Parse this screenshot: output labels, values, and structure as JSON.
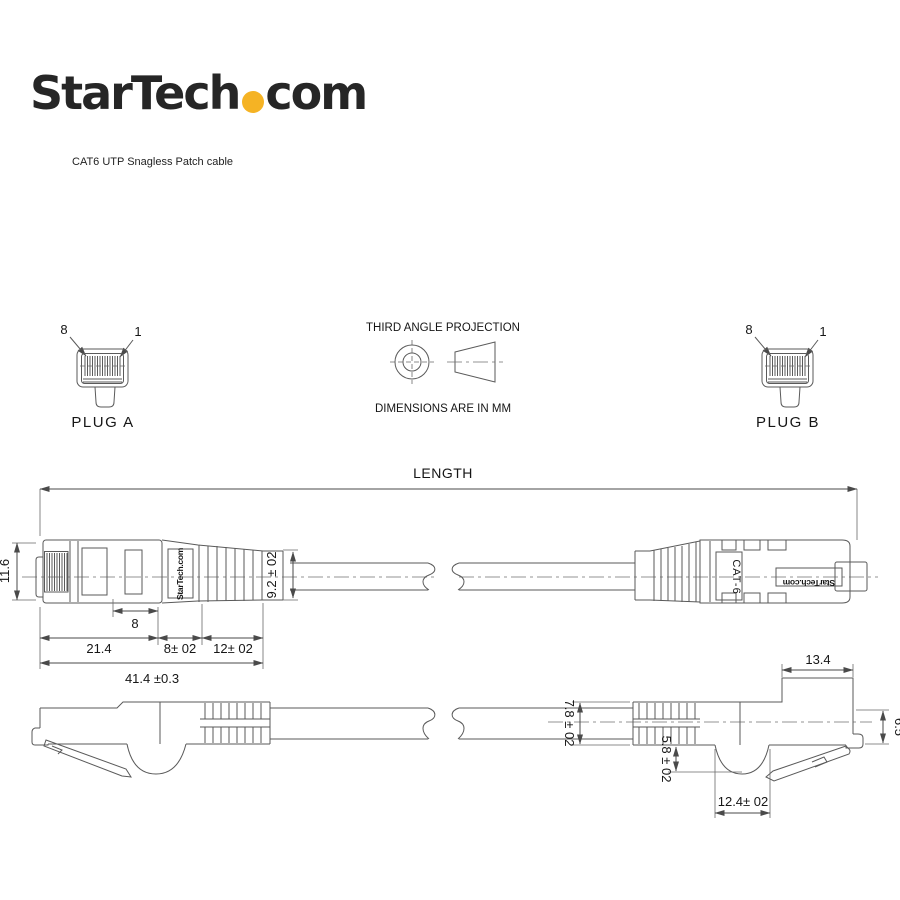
{
  "header": {
    "logo_part1": "StarTech",
    "logo_part2": "com",
    "subtitle": "CAT6 UTP Snagless Patch cable"
  },
  "projection": {
    "title": "THIRD ANGLE PROJECTION",
    "units": "DIMENSIONS ARE IN MM"
  },
  "plug_a": {
    "label": "PLUG A",
    "pin_left": "8",
    "pin_right": "1"
  },
  "plug_b": {
    "label": "PLUG B",
    "pin_left": "8",
    "pin_right": "1"
  },
  "top_view": {
    "length_label": "LENGTH",
    "brand_boot": "StarTech.com",
    "cat_label": "CAT-6",
    "brand_tab": "StarTech.com"
  },
  "dims": {
    "front_height": "11.6",
    "pin_section": "8",
    "body_length": "21.4",
    "mid_length": "8± 02",
    "boot_length": "12± 02",
    "total_length": "41.4 ±0.3",
    "boot_height": "9.2 ± 02",
    "front_length": "13.4",
    "cable_height": "7.8 ± 02",
    "latch_depth": "5.8 ± 02",
    "hump_width": "12.4± 02",
    "nose_height": "6.5"
  },
  "colors": {
    "line": "#5a5a5a",
    "text": "#161616",
    "accent": "#f5b324"
  }
}
